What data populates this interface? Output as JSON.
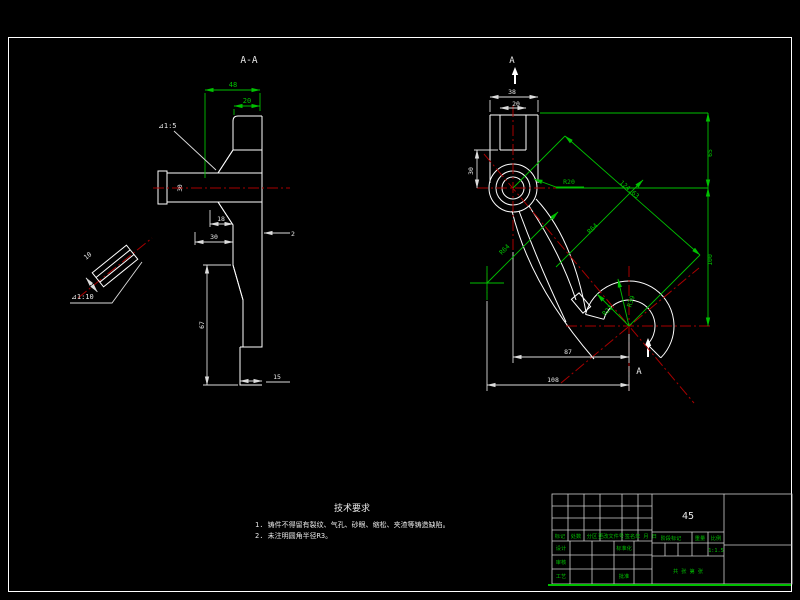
{
  "colors": {
    "background": "#000000",
    "geometry": "#ffffff",
    "dimension_green": "#00c000",
    "centerline_red": "#a80000",
    "hatch": "#9fd8d8"
  },
  "section_view": {
    "title": "A-A",
    "dims": {
      "width_48": "48",
      "width_20": "20",
      "taper": "⊿1:5",
      "bore": "30",
      "hub_18": "18",
      "hub_30": "30",
      "step_2": "2",
      "height_67": "67",
      "foot_15": "15"
    }
  },
  "detail_view": {
    "dims": {
      "len_10": "10",
      "taper": "⊿1:10"
    }
  },
  "front_view": {
    "section_label_top": "A",
    "section_label_bottom": "A",
    "dims": {
      "boss_38": "38",
      "slot_20": "20",
      "depth_30": "30",
      "radius_r20": "R20",
      "height_65": "65",
      "length_124": "124.63",
      "radius_r64_a": "R64",
      "radius_r64_b": "R64",
      "height_100": "100",
      "radius_r22": "R22",
      "radius_r39": "R39",
      "span_87": "87",
      "span_108": "108"
    }
  },
  "tech_requirements": {
    "title": "技术要求",
    "items": [
      "1. 铸件不得留有裂纹、气孔、砂眼、缩松、夹渣等铸造缺陷。",
      "2. 未注明圆角半径R3。"
    ]
  },
  "title_block": {
    "material": "45",
    "scale": "1:1.5",
    "revision_columns": [
      "标记",
      "处数",
      "分区",
      "更改文件号",
      "签名",
      "年 月 日"
    ],
    "roles": {
      "design": "设计",
      "standardization": "标准化",
      "check": "审核",
      "process": "工艺",
      "approve": "批准"
    },
    "stage_label": "阶段标记",
    "weight_label": "重量",
    "scale_label": "比例",
    "sheet_info": "共 张 第 张"
  }
}
